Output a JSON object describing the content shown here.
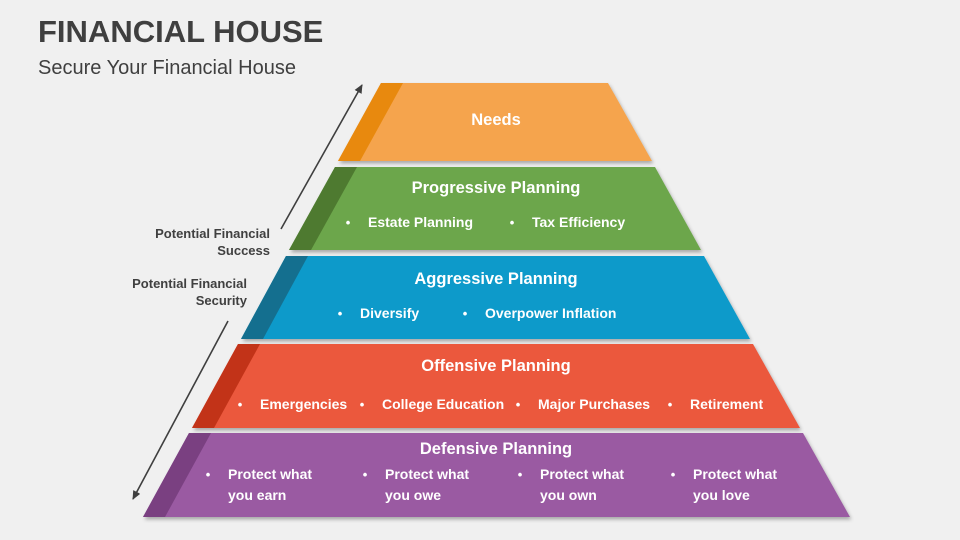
{
  "colors": {
    "background": "#f0f0f0",
    "heading_text": "#3f3f3f",
    "side_label_text": "#404040",
    "level_text": "#ffffff",
    "arrow": "#3f3f3f"
  },
  "header": {
    "title": "FINANCIAL HOUSE",
    "subtitle": "Secure Your Financial House"
  },
  "side_labels": {
    "success": "Potential Financial Success",
    "security": "Potential Financial Security"
  },
  "pyramid": {
    "levels": [
      {
        "name": "Needs",
        "fill": "#F5A44D",
        "edge_fill": "#E8890E",
        "bullets": []
      },
      {
        "name": "Progressive Planning",
        "fill": "#6CA64B",
        "edge_fill": "#4E7A30",
        "bullets": [
          "Estate Planning",
          "Tax Efficiency"
        ]
      },
      {
        "name": "Aggressive Planning",
        "fill": "#0F9ACA",
        "edge_fill": "#146F8F",
        "bullets": [
          "Diversify",
          "Overpower Inflation"
        ]
      },
      {
        "name": "Offensive Planning",
        "fill": "#EB583E",
        "edge_fill": "#C23318",
        "bullets": [
          "Emergencies",
          "College Education",
          "Major Purchases",
          "Retirement"
        ]
      },
      {
        "name": "Defensive Planning",
        "fill": "#9A5AA2",
        "edge_fill": "#7A4081",
        "bullets": [
          "Protect what you earn",
          "Protect what you owe",
          "Protect what you own",
          "Protect what you love"
        ]
      }
    ]
  }
}
